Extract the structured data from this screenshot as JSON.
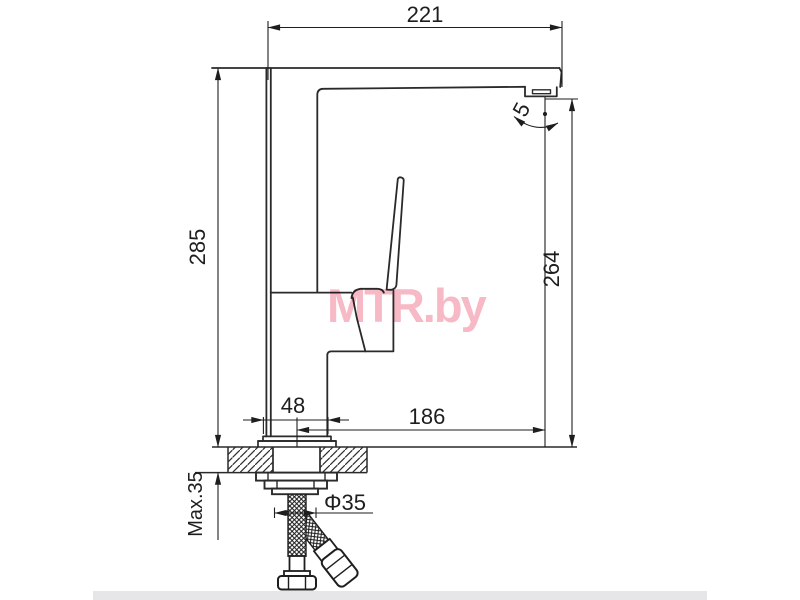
{
  "page": {
    "background": "#ffffff",
    "footer_strip_color": "#e6e6e8"
  },
  "watermark": {
    "text": "MTR.by",
    "color": "#f6b9c5"
  },
  "drawing": {
    "subject": "single-lever kitchen faucet side-view installation drawing",
    "line_color": "#2a2a2a",
    "dimensions": {
      "spout_width": "221",
      "total_height": "285",
      "outlet_height": "264",
      "spout_reach": "186",
      "body_width": "48",
      "outlet_angle": "5",
      "max_mounting_thickness": "Max.35",
      "hole_diameter": "Φ35"
    }
  }
}
